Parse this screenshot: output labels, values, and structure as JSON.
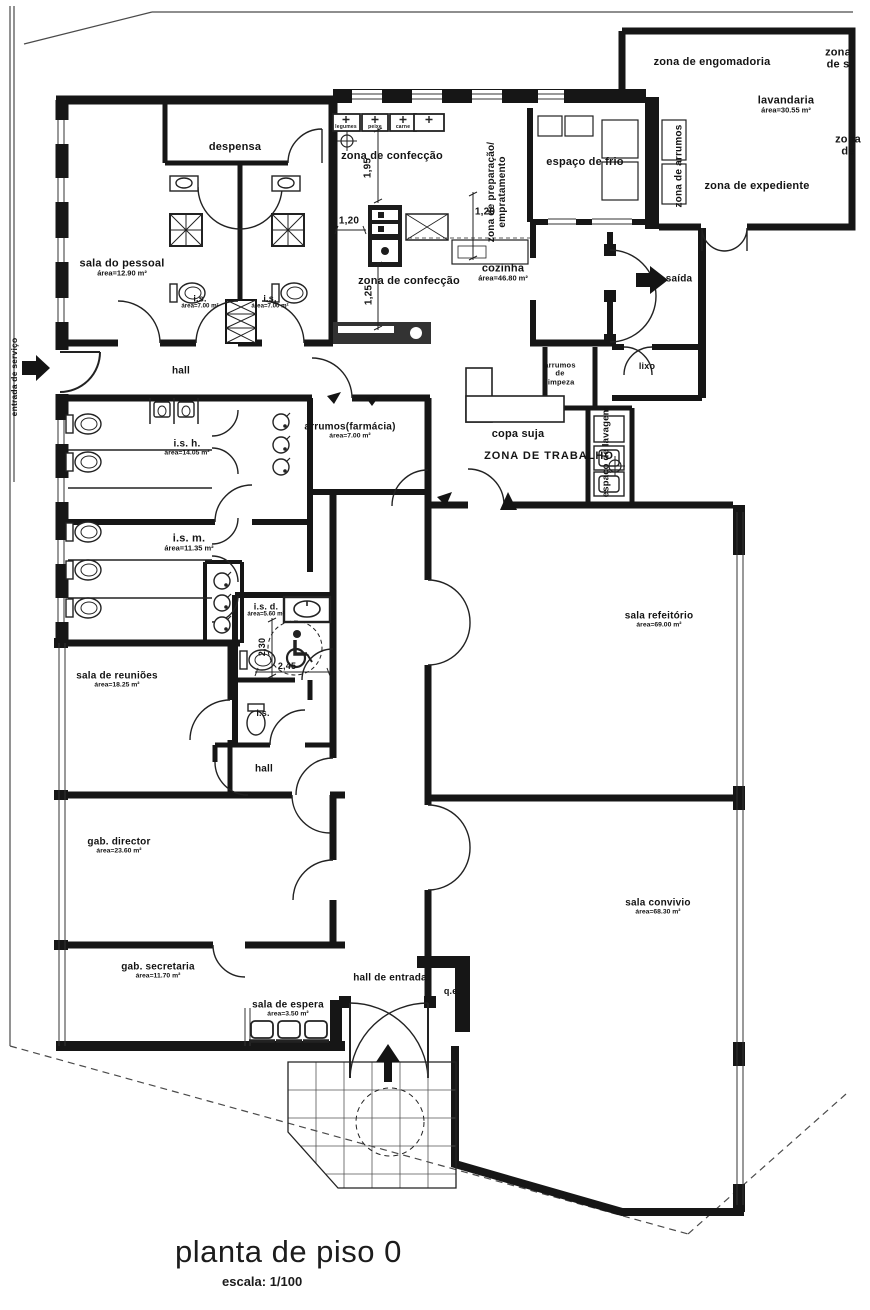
{
  "title": {
    "text": "planta de piso 0",
    "scale": "escala: 1/100"
  },
  "colors": {
    "paper": "#ffffff",
    "wall": "#161616",
    "ink": "#141414"
  },
  "icons": [
    "wheelchair-icon",
    "exit-arrow-icon",
    "entrance-arrow-icon",
    "service-entrance-arrow-icon",
    "flow-arrow-icon",
    "crosshair-symbol"
  ],
  "labels": [
    {
      "name": "label-zona-de-engomadoria",
      "text": "zona de engomadoria",
      "x": 712,
      "y": 62,
      "size": 11
    },
    {
      "name": "label-zona-de-s",
      "text": "zona de s",
      "x": 838,
      "y": 59,
      "size": 11
    },
    {
      "name": "label-lavandaria",
      "text": "lavandaria",
      "area": "área=30.55 m²",
      "x": 786,
      "y": 105,
      "size": 11
    },
    {
      "name": "label-zona-de",
      "text": "zona de",
      "x": 848,
      "y": 146,
      "size": 11
    },
    {
      "name": "label-zona-de-expediente",
      "text": "zona de expediente",
      "x": 757,
      "y": 186,
      "size": 11
    },
    {
      "name": "label-zona-de-arrumos",
      "text": "zona de arrumos",
      "x": 679,
      "y": 166,
      "rot": -90,
      "size": 10
    },
    {
      "name": "label-despensa",
      "text": "despensa",
      "x": 235,
      "y": 147,
      "size": 11
    },
    {
      "name": "label-zona-de-confeccao-top",
      "text": "zona de confecção",
      "x": 392,
      "y": 156,
      "size": 11
    },
    {
      "name": "label-zona-de-preparacao",
      "text": "zona de preparação/\nempratamento",
      "x": 497,
      "y": 192,
      "rot": -90,
      "size": 10
    },
    {
      "name": "label-espaco-de-frio",
      "text": "espaço de frio",
      "x": 585,
      "y": 162,
      "size": 11
    },
    {
      "name": "label-cozinha",
      "text": "cozinha",
      "area": "área=46.80 m²",
      "x": 503,
      "y": 273,
      "size": 11
    },
    {
      "name": "label-zona-de-confeccao-bottom",
      "text": "zona de confecção",
      "x": 409,
      "y": 281,
      "size": 11
    },
    {
      "name": "label-saida",
      "text": "saída",
      "x": 679,
      "y": 279,
      "size": 10
    },
    {
      "name": "label-sala-do-pessoal",
      "text": "sala do pessoal",
      "area": "área=12.90 m²",
      "x": 122,
      "y": 268,
      "size": 11
    },
    {
      "name": "label-is-1",
      "text": "i.s.",
      "area": "área=7.00 m²",
      "x": 200,
      "y": 302,
      "size": 9
    },
    {
      "name": "label-is-2",
      "text": "i.s.",
      "area": "área=7.00 m²",
      "x": 270,
      "y": 302,
      "size": 9
    },
    {
      "name": "label-hall-upper",
      "text": "hall",
      "x": 181,
      "y": 371,
      "size": 10
    },
    {
      "name": "label-arrumos-farmacia",
      "text": "arrumos(farmácia)",
      "area": "área=7.00 m²",
      "x": 350,
      "y": 431,
      "size": 10
    },
    {
      "name": "label-arrumos-de-limpeza",
      "text": "arrumos\nde\nlimpeza",
      "x": 560,
      "y": 374,
      "size": 7.5
    },
    {
      "name": "label-lixo",
      "text": "lixo",
      "x": 647,
      "y": 366,
      "size": 9
    },
    {
      "name": "label-copa-suja",
      "text": "copa suja",
      "x": 518,
      "y": 434,
      "size": 11
    },
    {
      "name": "label-zona-de-trabalho",
      "text": "ZONA DE TRABALHO",
      "x": 549,
      "y": 456,
      "size": 11,
      "ls": 1
    },
    {
      "name": "label-espaco-de-lavagem",
      "text": "espaço de lavagem",
      "x": 607,
      "y": 452,
      "rot": -90,
      "size": 9.5
    },
    {
      "name": "label-is-h",
      "text": "i.s. h.",
      "area": "área=14.05 m²",
      "x": 187,
      "y": 448,
      "size": 10
    },
    {
      "name": "label-is-m",
      "text": "i.s. m.",
      "area": "área=11.35 m²",
      "x": 189,
      "y": 543,
      "size": 11
    },
    {
      "name": "label-is-d",
      "text": "i.s. d.",
      "area": "área=5.60 m²",
      "x": 266,
      "y": 610,
      "size": 9
    },
    {
      "name": "label-sala-de-reunioes",
      "text": "sala de reuniões",
      "area": "área=18.25 m²",
      "x": 117,
      "y": 680,
      "size": 10
    },
    {
      "name": "label-is-small",
      "text": "i.s.",
      "x": 263,
      "y": 713,
      "size": 9
    },
    {
      "name": "label-hall-mid",
      "text": "hall",
      "x": 264,
      "y": 769,
      "size": 10
    },
    {
      "name": "label-sala-refeitorio",
      "text": "sala refeitório",
      "area": "área=69.00 m²",
      "x": 659,
      "y": 620,
      "size": 10
    },
    {
      "name": "label-gab-director",
      "text": "gab. director",
      "area": "área=23.60 m²",
      "x": 119,
      "y": 846,
      "size": 10
    },
    {
      "name": "label-sala-convivio",
      "text": "sala convivio",
      "area": "área=68.30 m²",
      "x": 658,
      "y": 907,
      "size": 10
    },
    {
      "name": "label-gab-secretaria",
      "text": "gab. secretaria",
      "area": "área=11.70 m²",
      "x": 158,
      "y": 971,
      "size": 10
    },
    {
      "name": "label-sala-de-espera",
      "text": "sala de espera",
      "area": "área=3.50 m²",
      "x": 288,
      "y": 1009,
      "size": 10
    },
    {
      "name": "label-hall-de-entrada",
      "text": "hall de entrada",
      "x": 390,
      "y": 978,
      "size": 10
    },
    {
      "name": "label-qe",
      "text": "q.e.",
      "x": 452,
      "y": 991,
      "size": 9
    },
    {
      "name": "label-entrada-de-servico",
      "text": "entrada de serviço",
      "x": 15,
      "y": 377,
      "rot": -90,
      "size": 8.5
    },
    {
      "name": "dim-1-95",
      "text": "1,95",
      "x": 368,
      "y": 168,
      "rot": -90,
      "size": 10
    },
    {
      "name": "dim-1-20-left",
      "text": "1,20",
      "x": 349,
      "y": 221,
      "size": 10
    },
    {
      "name": "dim-1-20-right",
      "text": "1,20",
      "x": 485,
      "y": 212,
      "size": 10
    },
    {
      "name": "dim-1-25",
      "text": "1,25",
      "x": 369,
      "y": 295,
      "rot": -90,
      "size": 10
    },
    {
      "name": "dim-2-30",
      "text": "2,30",
      "x": 262,
      "y": 647,
      "rot": -90,
      "size": 9
    },
    {
      "name": "dim-2-45",
      "text": "2,45",
      "x": 287,
      "y": 666,
      "size": 9
    },
    {
      "name": "box-label-legumes",
      "text": "legumes",
      "x": 346,
      "y": 128,
      "size": 5
    },
    {
      "name": "box-label-peixe",
      "text": "peixe",
      "x": 375,
      "y": 128,
      "size": 5
    },
    {
      "name": "box-label-carne",
      "text": "carne",
      "x": 403,
      "y": 128,
      "size": 5
    }
  ]
}
